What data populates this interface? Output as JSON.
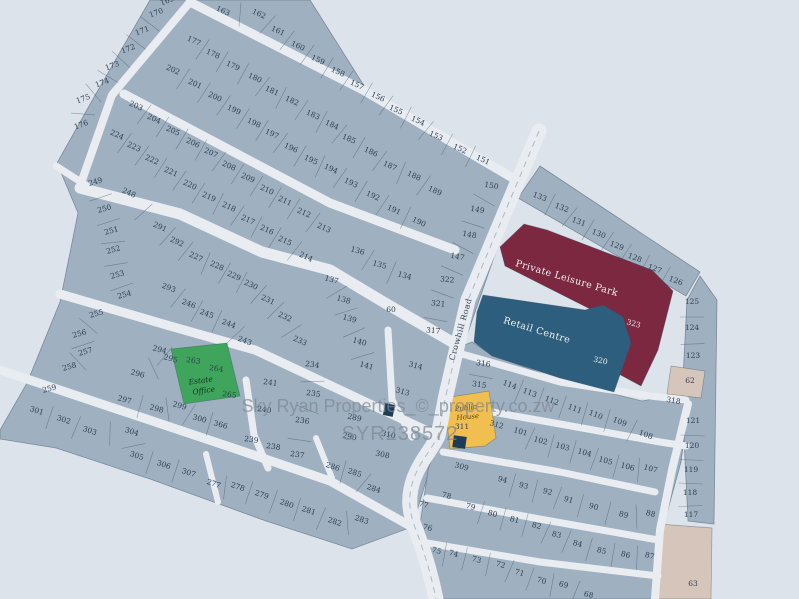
{
  "map": {
    "watermark": {
      "line1": "Sky Ryan Properties_©_property.co.zw",
      "line2": "SYR238572"
    },
    "road_name": "Crowhill Road",
    "areas": {
      "leisure_park": {
        "label": "Private Leisure Park",
        "plot": "323",
        "color": "#7b2840"
      },
      "retail_centre": {
        "label": "Retail Centre",
        "plot": "320",
        "color": "#2e5e7e"
      },
      "estate_office": {
        "word1": "Estate",
        "word2": "Office",
        "plots": "263, 264",
        "color": "#3fa45c"
      },
      "public_house": {
        "word1": "Public",
        "word2": "House",
        "plot": "311",
        "color": "#f1bf4f"
      },
      "reserved_plots": "62, 63"
    },
    "colors": {
      "background": "#dde3ea",
      "plot_fill": "#9fb1c0",
      "road": "#e9edf2",
      "plot_border": "#5f7384",
      "number_text": "#2e4154",
      "beige_plot": "#d6c5ba",
      "marker_navy": "#1e3c56",
      "watermark": "#7e8894"
    },
    "plots": [
      [
        "169",
        168,
        3,
        -20
      ],
      [
        "170",
        157,
        15,
        -20
      ],
      [
        "171",
        143,
        33,
        -20
      ],
      [
        "172",
        129,
        51,
        -20
      ],
      [
        "173",
        113,
        68,
        -20
      ],
      [
        "174",
        103,
        85,
        -20
      ],
      [
        "175",
        84,
        101,
        -20
      ],
      [
        "176",
        82,
        127,
        -20
      ],
      [
        "249",
        96,
        184,
        -15
      ],
      [
        "250",
        105,
        211,
        -15
      ],
      [
        "251",
        112,
        233,
        -15
      ],
      [
        "252",
        114,
        252,
        -15
      ],
      [
        "253",
        118,
        277,
        -15
      ],
      [
        "254",
        125,
        297,
        -15
      ],
      [
        "255",
        97,
        316,
        -15
      ],
      [
        "256",
        80,
        336,
        -15
      ],
      [
        "257",
        86,
        354,
        -15
      ],
      [
        "258",
        70,
        369,
        -15
      ],
      [
        "259",
        50,
        391,
        -15
      ],
      [
        "163",
        222,
        13,
        24
      ],
      [
        "162",
        258,
        16,
        24
      ],
      [
        "161",
        277,
        33,
        24
      ],
      [
        "160",
        297,
        48,
        24
      ],
      [
        "159",
        317,
        62,
        24
      ],
      [
        "158",
        337,
        74,
        24
      ],
      [
        "157",
        356,
        87,
        24
      ],
      [
        "156",
        377,
        99,
        24
      ],
      [
        "155",
        395,
        112,
        24
      ],
      [
        "154",
        417,
        123,
        24
      ],
      [
        "153",
        435,
        138,
        24
      ],
      [
        "152",
        459,
        151,
        24
      ],
      [
        "151",
        482,
        162,
        24
      ],
      [
        "150",
        491,
        188,
        10
      ],
      [
        "149",
        477,
        212,
        10
      ],
      [
        "148",
        469,
        237,
        10
      ],
      [
        "147",
        457,
        259,
        10
      ],
      [
        "322",
        447,
        282,
        5
      ],
      [
        "321",
        438,
        306,
        5
      ],
      [
        "317",
        433,
        333,
        5
      ],
      [
        "177",
        193,
        43,
        24
      ],
      [
        "178",
        212,
        56,
        24
      ],
      [
        "179",
        232,
        68,
        24
      ],
      [
        "180",
        254,
        80,
        24
      ],
      [
        "181",
        271,
        93,
        24
      ],
      [
        "182",
        291,
        103,
        24
      ],
      [
        "183",
        312,
        117,
        24
      ],
      [
        "184",
        331,
        127,
        24
      ],
      [
        "185",
        348,
        141,
        24
      ],
      [
        "186",
        370,
        154,
        24
      ],
      [
        "187",
        389,
        168,
        24
      ],
      [
        "188",
        413,
        178,
        24
      ],
      [
        "189",
        434,
        193,
        24
      ],
      [
        "202",
        172,
        72,
        24
      ],
      [
        "201",
        194,
        86,
        24
      ],
      [
        "200",
        214,
        99,
        24
      ],
      [
        "199",
        233,
        112,
        24
      ],
      [
        "198",
        253,
        125,
        24
      ],
      [
        "197",
        271,
        136,
        24
      ],
      [
        "196",
        290,
        150,
        24
      ],
      [
        "195",
        310,
        162,
        24
      ],
      [
        "194",
        330,
        171,
        24
      ],
      [
        "193",
        350,
        185,
        24
      ],
      [
        "192",
        372,
        198,
        24
      ],
      [
        "191",
        393,
        212,
        24
      ],
      [
        "190",
        418,
        224,
        24
      ],
      [
        "203",
        135,
        108,
        24
      ],
      [
        "204",
        153,
        121,
        24
      ],
      [
        "205",
        172,
        133,
        24
      ],
      [
        "206",
        192,
        145,
        24
      ],
      [
        "207",
        210,
        155,
        24
      ],
      [
        "208",
        228,
        168,
        24
      ],
      [
        "209",
        247,
        180,
        24
      ],
      [
        "210",
        266,
        192,
        24
      ],
      [
        "211",
        284,
        203,
        24
      ],
      [
        "212",
        303,
        215,
        24
      ],
      [
        "213",
        323,
        230,
        24
      ],
      [
        "224",
        116,
        137,
        24
      ],
      [
        "223",
        133,
        149,
        24
      ],
      [
        "222",
        151,
        162,
        24
      ],
      [
        "221",
        170,
        174,
        24
      ],
      [
        "220",
        189,
        187,
        24
      ],
      [
        "219",
        208,
        199,
        24
      ],
      [
        "218",
        228,
        209,
        24
      ],
      [
        "217",
        247,
        222,
        24
      ],
      [
        "216",
        266,
        232,
        24
      ],
      [
        "215",
        284,
        243,
        24
      ],
      [
        "214",
        305,
        259,
        24
      ],
      [
        "248",
        128,
        195,
        24
      ],
      [
        "291",
        159,
        229,
        24
      ],
      [
        "292",
        176,
        244,
        24
      ],
      [
        "227",
        195,
        259,
        24
      ],
      [
        "228",
        216,
        268,
        24
      ],
      [
        "229",
        233,
        278,
        24
      ],
      [
        "230",
        250,
        287,
        24
      ],
      [
        "231",
        267,
        302,
        24
      ],
      [
        "232",
        284,
        319,
        24
      ],
      [
        "233",
        299,
        343,
        24
      ],
      [
        "234",
        312,
        367,
        8
      ],
      [
        "235",
        313,
        396,
        8
      ],
      [
        "236",
        302,
        423,
        8
      ],
      [
        "237",
        297,
        457,
        8
      ],
      [
        "238",
        273,
        449,
        8
      ],
      [
        "239",
        251,
        442,
        8
      ],
      [
        "240",
        264,
        412,
        8
      ],
      [
        "241",
        270,
        385,
        8
      ],
      [
        "293",
        168,
        290,
        20
      ],
      [
        "246",
        188,
        306,
        20
      ],
      [
        "245",
        206,
        316,
        20
      ],
      [
        "244",
        228,
        326,
        20
      ],
      [
        "243",
        244,
        343,
        20
      ],
      [
        "136",
        357,
        253,
        15
      ],
      [
        "135",
        379,
        267,
        15
      ],
      [
        "134",
        404,
        278,
        15
      ],
      [
        "137",
        331,
        282,
        15
      ],
      [
        "138",
        343,
        302,
        15
      ],
      [
        "139",
        349,
        321,
        15
      ],
      [
        "140",
        359,
        344,
        15
      ],
      [
        "141",
        366,
        368,
        15
      ],
      [
        "60",
        391,
        312,
        0
      ],
      [
        "314",
        415,
        368,
        15
      ],
      [
        "313",
        402,
        394,
        15
      ],
      [
        "294",
        159,
        352,
        15
      ],
      [
        "295",
        170,
        361,
        15
      ],
      [
        "296",
        137,
        376,
        15
      ],
      [
        "297",
        124,
        402,
        15
      ],
      [
        "298",
        156,
        411,
        15
      ],
      [
        "299",
        179,
        408,
        15
      ],
      [
        "300",
        199,
        421,
        15
      ],
      [
        "366",
        220,
        427,
        15
      ],
      [
        "265",
        229,
        397,
        8
      ],
      [
        "301",
        36,
        413,
        18
      ],
      [
        "302",
        63,
        422,
        18
      ],
      [
        "303",
        89,
        433,
        18
      ],
      [
        "304",
        131,
        434,
        18
      ],
      [
        "305",
        136,
        458,
        18
      ],
      [
        "306",
        163,
        467,
        18
      ],
      [
        "307",
        188,
        475,
        18
      ],
      [
        "277",
        213,
        486,
        18
      ],
      [
        "278",
        237,
        489,
        18
      ],
      [
        "279",
        261,
        497,
        18
      ],
      [
        "280",
        286,
        506,
        18
      ],
      [
        "281",
        308,
        513,
        18
      ],
      [
        "282",
        334,
        524,
        18
      ],
      [
        "283",
        361,
        522,
        18
      ],
      [
        "284",
        373,
        491,
        18
      ],
      [
        "285",
        354,
        475,
        18
      ],
      [
        "286",
        332,
        469,
        18
      ],
      [
        "289",
        354,
        420,
        12
      ],
      [
        "290",
        349,
        439,
        12
      ],
      [
        "308",
        382,
        457,
        12
      ],
      [
        "310",
        388,
        437,
        12
      ],
      [
        "263",
        193,
        363,
        8
      ],
      [
        "264",
        216,
        371,
        8
      ],
      [
        "316",
        483,
        366,
        8
      ],
      [
        "315",
        479,
        387,
        8
      ],
      [
        "114",
        509,
        387,
        20
      ],
      [
        "113",
        529,
        395,
        20
      ],
      [
        "112",
        551,
        403,
        20
      ],
      [
        "111",
        574,
        411,
        20
      ],
      [
        "110",
        595,
        417,
        20
      ],
      [
        "109",
        619,
        424,
        20
      ],
      [
        "108",
        645,
        437,
        20
      ],
      [
        "318",
        673,
        403,
        10
      ],
      [
        "311",
        462,
        429,
        0
      ],
      [
        "312",
        496,
        427,
        15
      ],
      [
        "101",
        520,
        434,
        15
      ],
      [
        "102",
        540,
        443,
        15
      ],
      [
        "103",
        562,
        449,
        15
      ],
      [
        "104",
        584,
        455,
        15
      ],
      [
        "105",
        605,
        463,
        15
      ],
      [
        "106",
        627,
        469,
        15
      ],
      [
        "107",
        650,
        471,
        15
      ],
      [
        "309",
        461,
        469,
        15
      ],
      [
        "94",
        502,
        482,
        15
      ],
      [
        "93",
        523,
        488,
        15
      ],
      [
        "92",
        547,
        494,
        15
      ],
      [
        "91",
        568,
        502,
        15
      ],
      [
        "90",
        593,
        509,
        15
      ],
      [
        "89",
        623,
        517,
        15
      ],
      [
        "88",
        650,
        516,
        15
      ],
      [
        "78",
        446,
        498,
        15
      ],
      [
        "77",
        423,
        507,
        15
      ],
      [
        "79",
        470,
        509,
        15
      ],
      [
        "80",
        492,
        516,
        15
      ],
      [
        "81",
        514,
        522,
        15
      ],
      [
        "82",
        536,
        528,
        15
      ],
      [
        "83",
        556,
        537,
        15
      ],
      [
        "84",
        577,
        546,
        15
      ],
      [
        "85",
        601,
        553,
        15
      ],
      [
        "86",
        625,
        557,
        15
      ],
      [
        "87",
        649,
        558,
        15
      ],
      [
        "76",
        427,
        530,
        15
      ],
      [
        "75",
        436,
        553,
        15
      ],
      [
        "74",
        453,
        556,
        15
      ],
      [
        "73",
        476,
        562,
        15
      ],
      [
        "72",
        500,
        567,
        15
      ],
      [
        "71",
        519,
        575,
        15
      ],
      [
        "70",
        541,
        583,
        15
      ],
      [
        "69",
        563,
        587,
        15
      ],
      [
        "68",
        588,
        597,
        15
      ],
      [
        "133",
        539,
        199,
        20
      ],
      [
        "132",
        561,
        210,
        20
      ],
      [
        "131",
        578,
        224,
        20
      ],
      [
        "130",
        598,
        236,
        20
      ],
      [
        "129",
        616,
        248,
        20
      ],
      [
        "128",
        634,
        260,
        20
      ],
      [
        "127",
        654,
        271,
        20
      ],
      [
        "126",
        675,
        283,
        20
      ],
      [
        "125",
        692,
        304,
        0
      ],
      [
        "124",
        692,
        330,
        0
      ],
      [
        "123",
        693,
        358,
        0
      ],
      [
        "121",
        693,
        423,
        0
      ],
      [
        "120",
        692,
        448,
        0
      ],
      [
        "119",
        691,
        472,
        0
      ],
      [
        "118",
        690,
        495,
        0
      ],
      [
        "117",
        691,
        517,
        0
      ],
      [
        "62",
        690,
        383,
        0
      ],
      [
        "63",
        693,
        586,
        0
      ]
    ]
  }
}
